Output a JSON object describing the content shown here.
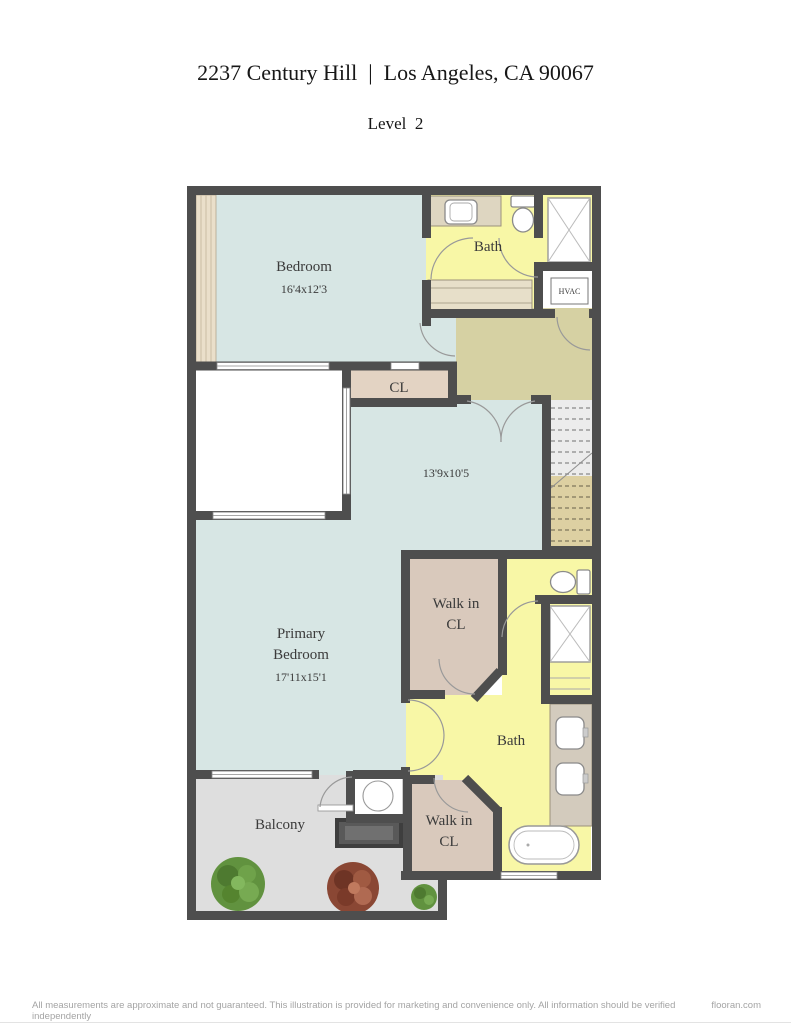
{
  "header": {
    "title": "2237 Century Hill  |  Los Angeles, CA 90067",
    "subtitle": "Level  2"
  },
  "rooms": {
    "bedroom": {
      "name": "Bedroom",
      "dims": "16'4x12'3"
    },
    "bath_top": {
      "name": "Bath"
    },
    "hvac": {
      "name": "HVAC"
    },
    "closet": {
      "name": "CL"
    },
    "loft": {
      "dims": "13'9x10'5"
    },
    "primary_bedroom": {
      "name_line1": "Primary",
      "name_line2": "Bedroom",
      "dims": "17'11x15'1"
    },
    "walk_in_upper": {
      "line1": "Walk in",
      "line2": "CL"
    },
    "bath_lower": {
      "name": "Bath"
    },
    "walk_in_lower": {
      "line1": "Walk in",
      "line2": "CL"
    },
    "balcony": {
      "name": "Balcony"
    }
  },
  "footer": {
    "disclaimer": "All measurements are approximate and not guaranteed. This illustration is provided for marketing and convenience only. All information should be verified independently",
    "brand": "flooran.com"
  },
  "colors": {
    "wall": "#4e4e4e",
    "room_blue": "#d7e6e4",
    "bath_yellow": "#f8f7a6",
    "closet_tan": "#e3d3c3",
    "walkin_tan": "#d9c9bc",
    "hall_olive": "#d6d1a3",
    "balcony_gray": "#dedede",
    "stairs_upper": "#ececec",
    "stairs_lower": "#ddd0a2",
    "counter": "#e7dfc9"
  }
}
